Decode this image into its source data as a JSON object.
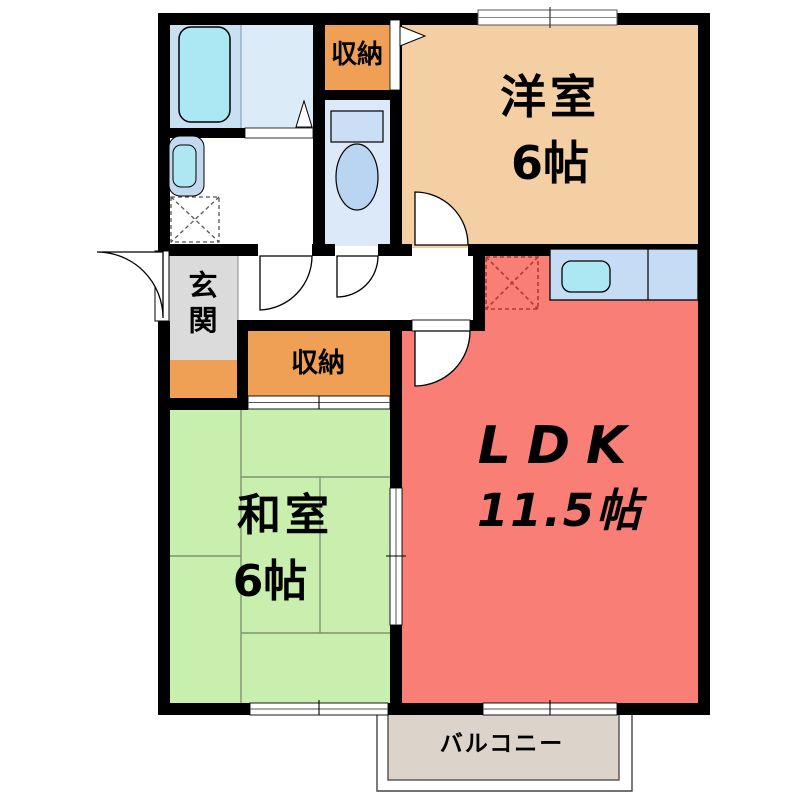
{
  "plan": {
    "rooms": {
      "western_room": {
        "label": "洋室",
        "size": "6帖"
      },
      "ldk": {
        "label": "LDK",
        "size": "11.5帖"
      },
      "japanese_room": {
        "label": "和室",
        "size": "6帖"
      },
      "entrance": {
        "label": "玄関"
      },
      "balcony": {
        "label": "バルコニー"
      },
      "closet_western": {
        "label": "収納"
      },
      "closet_japanese": {
        "label": "収納"
      }
    },
    "fixtures": {
      "bathtub": "bathtub-icon",
      "washbasin": "washbasin-icon",
      "washing_machine_space": "washing-machine-space-icon",
      "toilet": "toilet-icon",
      "kitchen_sink": "kitchen-sink-icon",
      "refrigerator_space": "refrigerator-space-icon"
    },
    "colors": {
      "wall": "#000000",
      "western_room": "#F4CFA4",
      "ldk": "#F97E76",
      "japanese_room": "#C9EFAE",
      "closet": "#EFA055",
      "entrance": "#DBDBDB",
      "entrance_step": "#EFA055",
      "balcony": "#DCD4CB",
      "bath_floor": "#C9DFF2",
      "washroom_floor": "#DCEBF8",
      "toilet_floor": "#DCE9F8",
      "water_fixture": "#ACE8F3",
      "kitchen_counter": "#C5DCF4",
      "refrigerator_dash": "#B03A32"
    }
  }
}
